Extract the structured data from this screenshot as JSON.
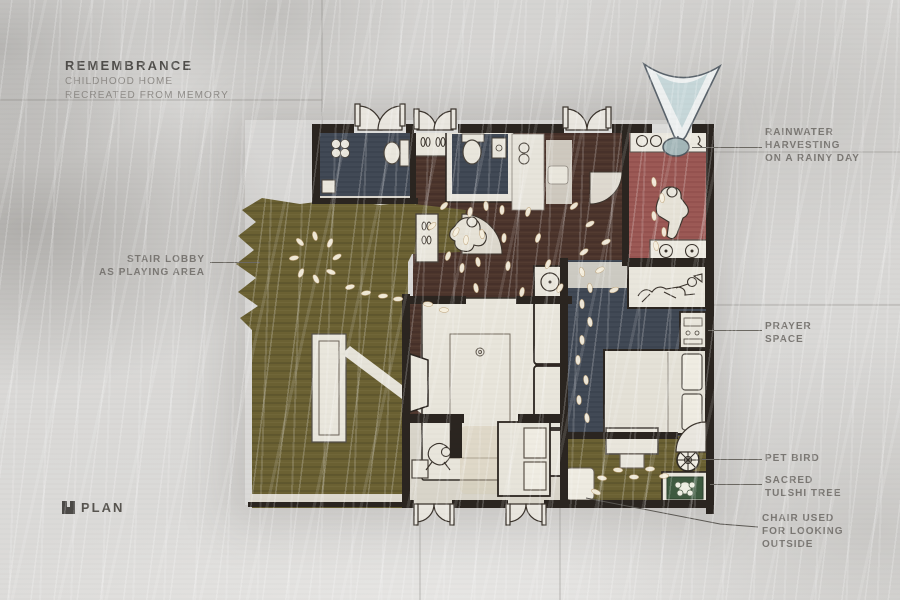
{
  "title_block": {
    "title": "REMEMBRANCE",
    "subtitle_line1": "CHILDHOOD HOME",
    "subtitle_line2": "RECREATED FROM MEMORY"
  },
  "plan_label": {
    "text": "PLAN"
  },
  "annotations": {
    "rainwater": "RAINWATER\nHARVESTING\nON A RAINY DAY",
    "stair_lobby": "STAIR LOBBY\nAS PLAYING AREA",
    "prayer": "PRAYER\nSPACE",
    "pet_bird": "PET BIRD",
    "tulshi": "SACRED\nTULSHI TREE",
    "chair": "CHAIR USED\nFOR LOOKING\nOUTSIDE"
  },
  "icons": {
    "plan_icon": "filled-square-with-notch",
    "rainwater_funnel": "v-shaped-funnel-collector",
    "bird_cage": "circular-cage-with-spokes",
    "tulshi_planter": "square-planter-with-plant"
  },
  "colors": {
    "background": "#d9d8d6",
    "wall": "#2b2520",
    "wood_olive": "#6b6133",
    "floor_brown": "#4d362d",
    "room_navy": "#424a56",
    "kitchen_red": "#9d5a56",
    "tulshi_green": "#3e5a40",
    "water_blue": "#c6d7d9",
    "annotation_gray": "#7a7773",
    "title_gray": "#4f4d4a"
  }
}
